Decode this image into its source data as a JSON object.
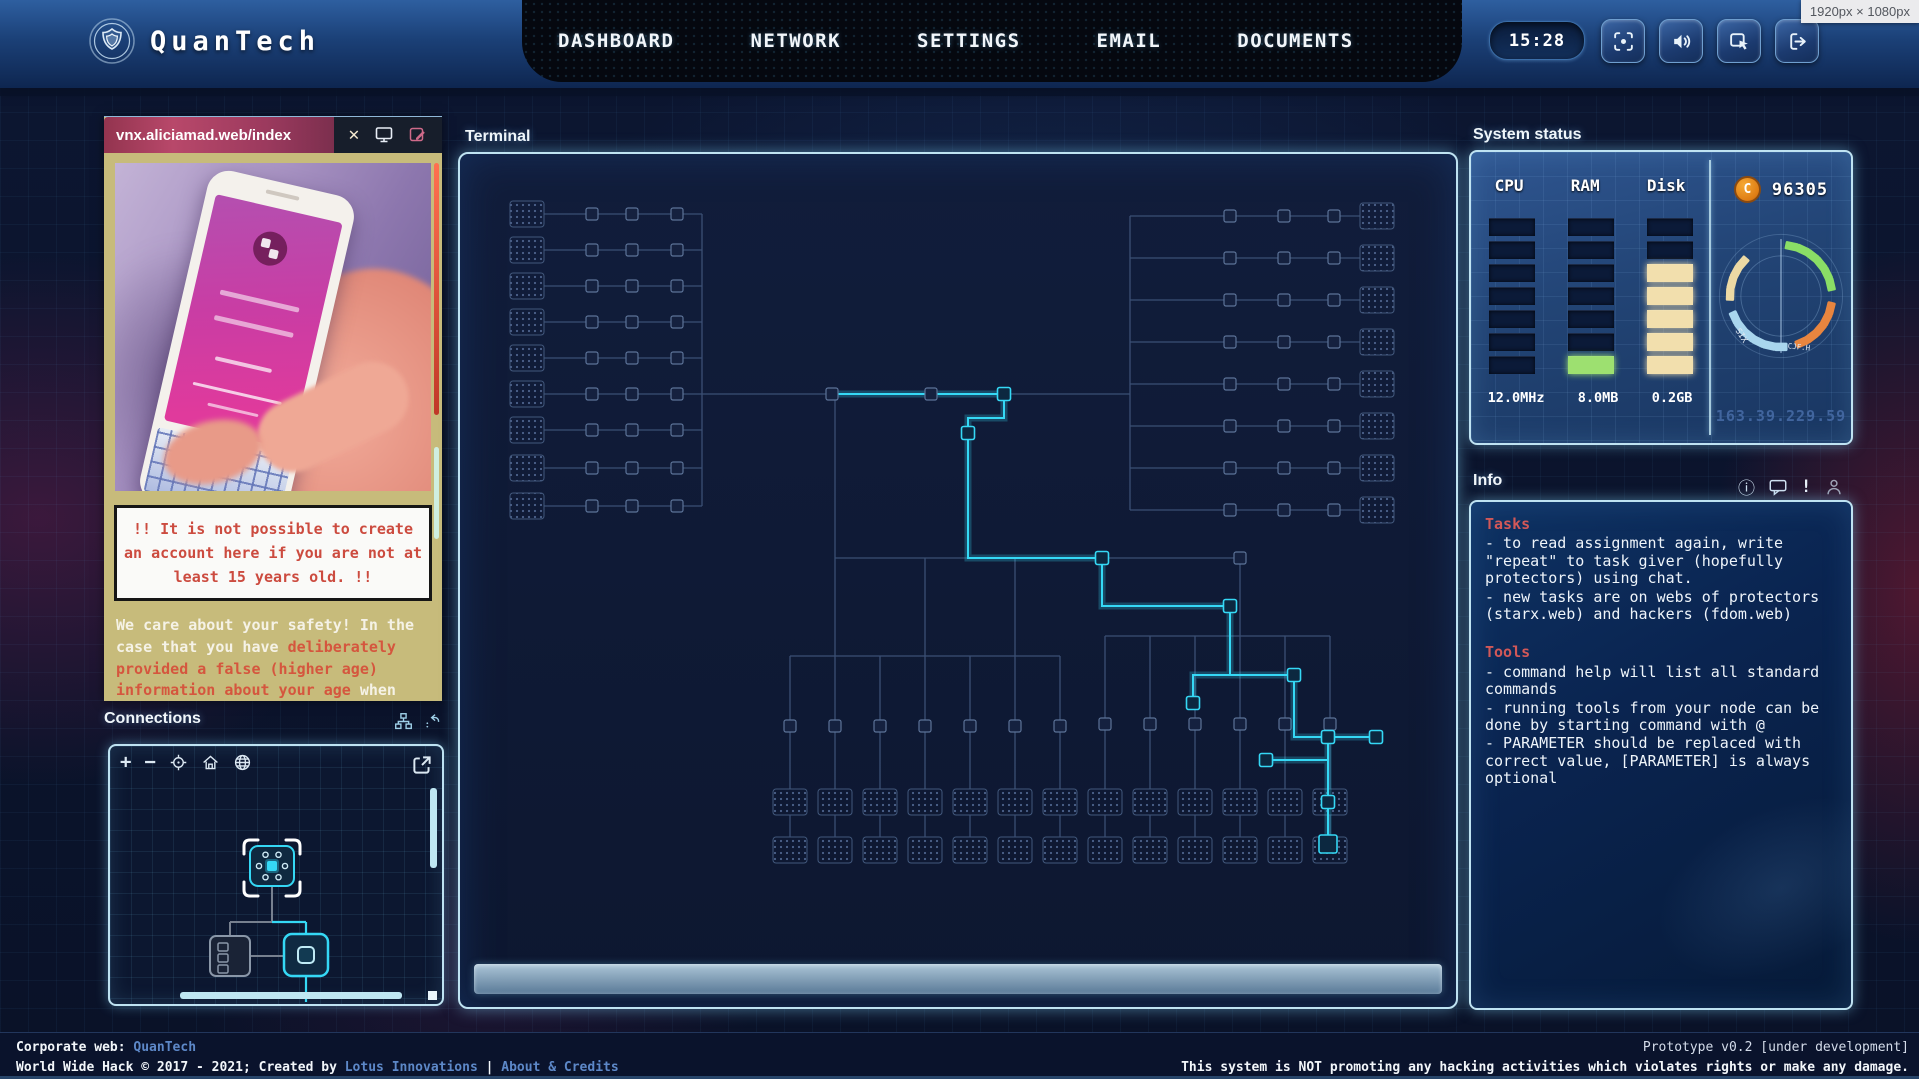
{
  "meta_tooltip": "1920px × 1080px",
  "header": {
    "logo": "QuanTech",
    "nav": [
      "DASHBOARD",
      "NETWORK",
      "SETTINGS",
      "EMAIL",
      "DOCUMENTS"
    ],
    "clock": "15:28"
  },
  "browser": {
    "url": "vnx.aliciamad.web/index",
    "close_label": "✕",
    "warning": "!! It is not possible to create an account here if you are not at least 15 years old. !!",
    "safety_white": "We care about your safety! In the case that you have ",
    "safety_red": "deliberately provided a false (higher age) information about your age",
    "safety_tail": " when"
  },
  "connections": {
    "title": "Connections"
  },
  "terminal": {
    "title": "Terminal"
  },
  "system_status": {
    "title": "System status",
    "columns": [
      {
        "label": "CPU",
        "value": "12.0MHz",
        "lit": 0,
        "lit_color": "#9de070"
      },
      {
        "label": "RAM",
        "value": "8.0MB",
        "lit": 1,
        "lit_color": "#9de070"
      },
      {
        "label": "Disk",
        "value": "0.2GB",
        "lit": 5,
        "lit_color": "#f2dfad"
      }
    ],
    "segments_total": 7,
    "coin_letter": "C",
    "credits": "96305",
    "ip": "163.39.229.59",
    "gauge_glyphs": [
      "SIX",
      "CJF.H"
    ]
  },
  "info": {
    "title": "Info",
    "alert_label": "!",
    "info_circle": "ⓘ",
    "tasks_title": "Tasks",
    "tasks": [
      "- to read assignment again, write \"repeat\" to task giver (hopefully protectors) using chat.",
      "- new tasks are on webs of protectors (starx.web) and hackers (fdom.web)"
    ],
    "tools_title": "Tools",
    "tools": [
      "- command help will list all standard commands",
      "- running tools from your node can be done by starting command with @",
      "- PARAMETER should be replaced with correct value, [PARAMETER] is always optional"
    ]
  },
  "footer": {
    "corporate_label": "Corporate web:",
    "corporate_link": "QuanTech",
    "line2_prefix": "World Wide Hack © 2017 - 2021; Created by ",
    "creator_link": "Lotus Innovations",
    "separator": " | ",
    "about_link": "About & Credits",
    "version": "Prototype v0.2 [under development]",
    "disclaimer": "This system is NOT promoting any hacking activities which violates rights or make any damage."
  },
  "colors": {
    "cyan_accent": "#35d8f5",
    "panel_border": "#bfe3f2",
    "edge": "#3b4f74",
    "node_stroke": "#5c7398",
    "node_fill": "#15213f",
    "warning_red": "#cc4b3f",
    "link_blue": "#5d88c8",
    "coin_orange": "#e8861f",
    "gauge_green": "#8ade66",
    "gauge_orange": "#e8853f",
    "gauge_blue": "#a9d6ee",
    "gauge_cream": "#ecd9a4"
  }
}
